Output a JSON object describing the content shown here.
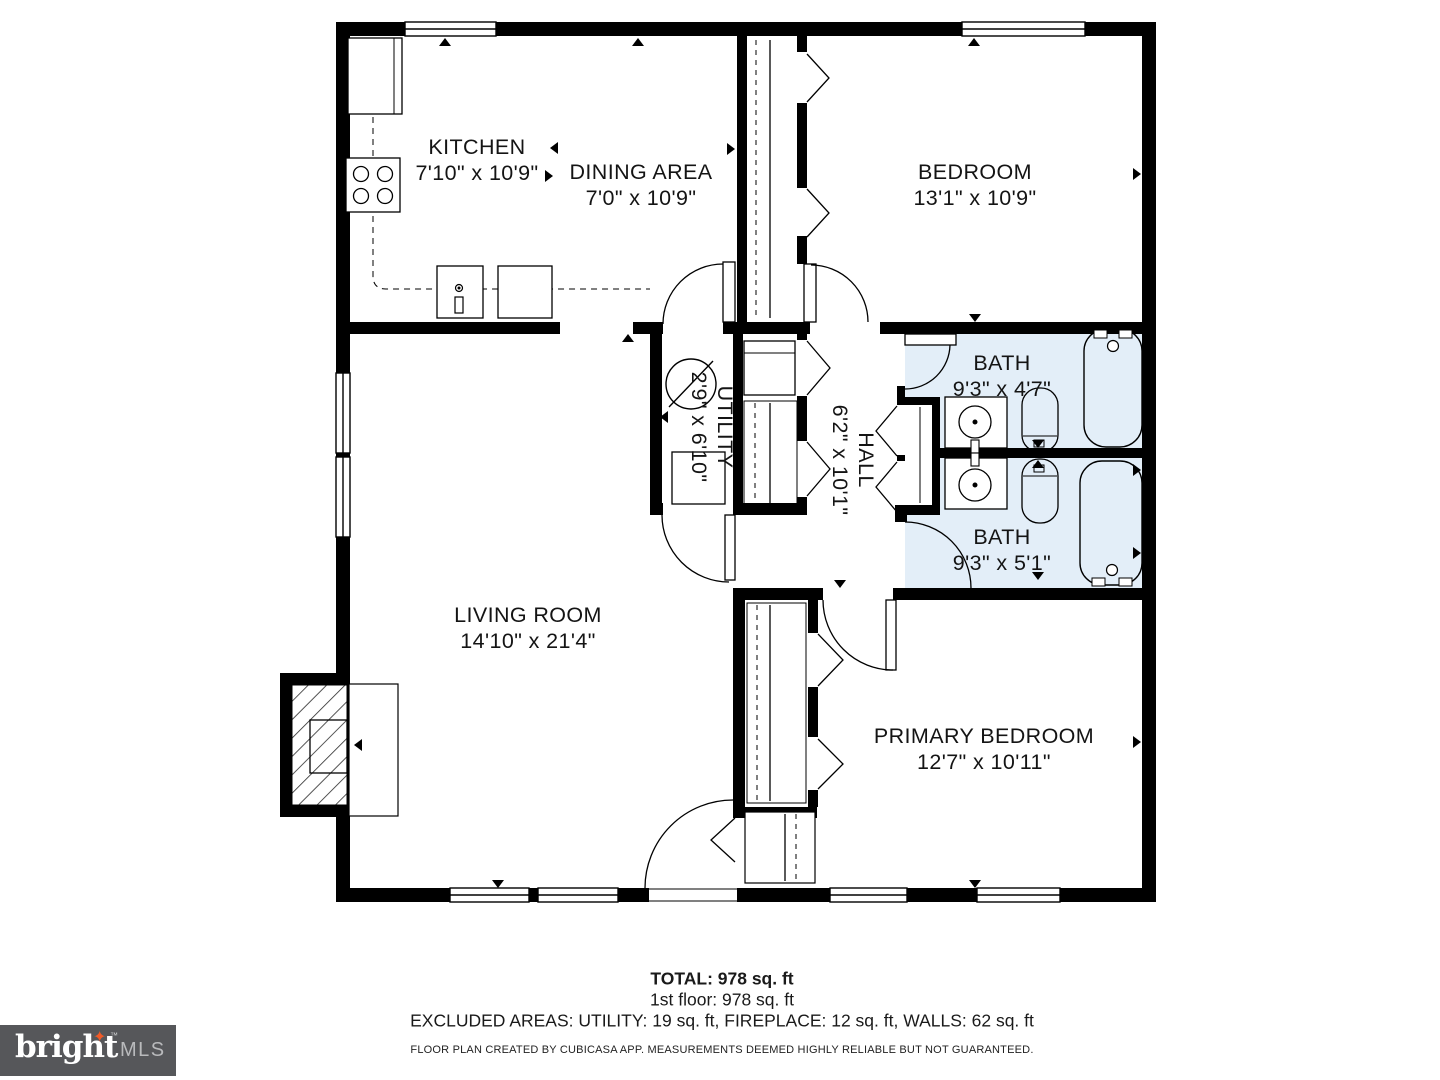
{
  "colors": {
    "wall": "#000000",
    "bath_floor": "#e3eef8",
    "logo_bg": "#56575a",
    "logo_star": "#f05a28",
    "logo_mls_text": "#b9babc"
  },
  "rooms": {
    "kitchen": {
      "name": "KITCHEN",
      "dims": "7'10\" x 10'9\""
    },
    "dining": {
      "name": "DINING AREA",
      "dims": "7'0\" x 10'9\""
    },
    "bedroom": {
      "name": "BEDROOM",
      "dims": "13'1\" x 10'9\""
    },
    "utility": {
      "name": "UTILITY",
      "dims": "2'9\" x 6'10\""
    },
    "hall": {
      "name": "HALL",
      "dims": "6'2\" x 10'1\""
    },
    "bath_top": {
      "name": "BATH",
      "dims": "9'3\" x 4'7\""
    },
    "bath_bottom": {
      "name": "BATH",
      "dims": "9'3\" x 5'1\""
    },
    "living": {
      "name": "LIVING ROOM",
      "dims": "14'10\" x 21'4\""
    },
    "primary": {
      "name": "PRIMARY BEDROOM",
      "dims": "12'7\" x 10'11\""
    }
  },
  "summary": {
    "total": "TOTAL: 978 sq. ft",
    "floor1": "1st floor: 978 sq. ft",
    "excluded": "EXCLUDED AREAS: UTILITY: 19 sq. ft, FIREPLACE: 12 sq. ft, WALLS: 62 sq. ft",
    "disclaimer": "FLOOR PLAN CREATED BY CUBICASA APP. MEASUREMENTS DEEMED HIGHLY RELIABLE BUT NOT GUARANTEED."
  },
  "logo": {
    "brand": "bright",
    "star": "✦",
    "tm": "™",
    "suffix": "MLS"
  }
}
